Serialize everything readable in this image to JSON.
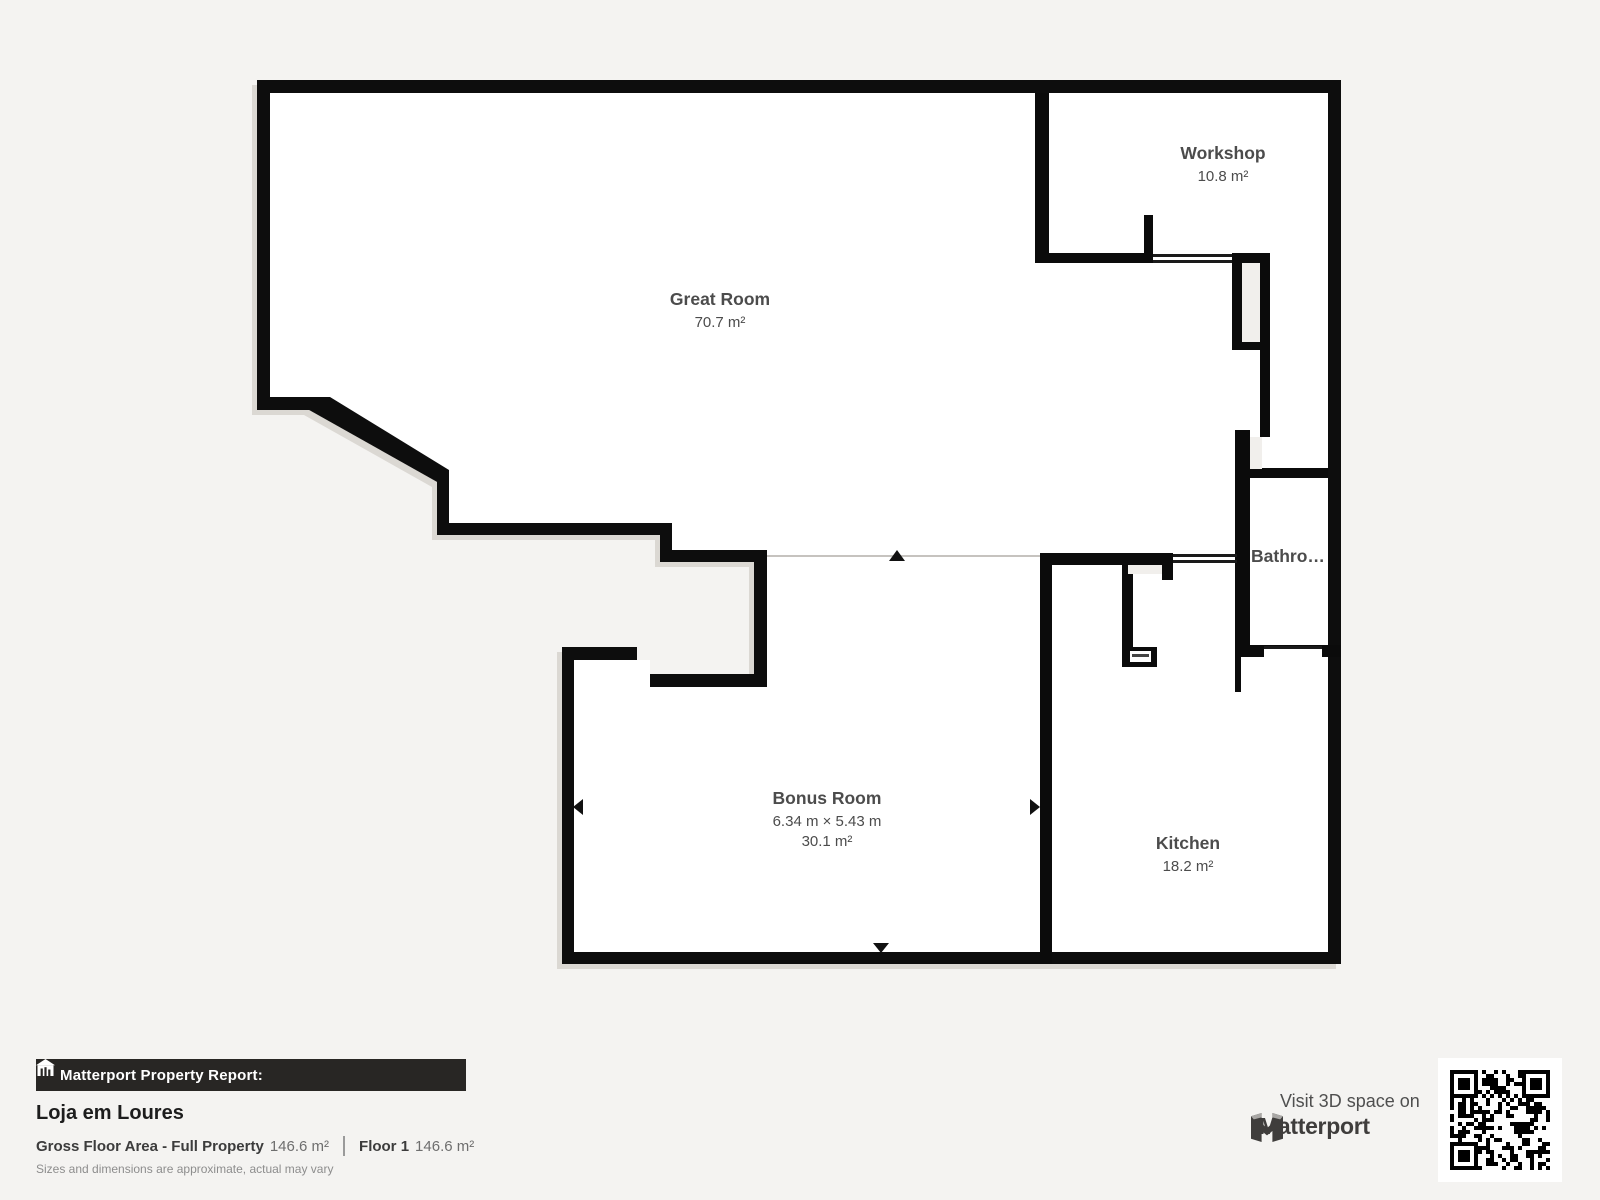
{
  "rooms": {
    "great_room": {
      "name": "Great Room",
      "area": "70.7 m²"
    },
    "workshop": {
      "name": "Workshop",
      "area": "10.8 m²"
    },
    "bathroom": {
      "name": "Bathro…"
    },
    "bonus_room": {
      "name": "Bonus Room",
      "dimensions": "6.34 m × 5.43 m",
      "area": "30.1 m²"
    },
    "kitchen": {
      "name": "Kitchen",
      "area": "18.2 m²"
    }
  },
  "report": {
    "banner_label": "Matterport Property Report:",
    "property_name": "Loja em Loures",
    "gfa_label": "Gross Floor Area - Full Property",
    "gfa_value": "146.6 m²",
    "floor_label": "Floor 1",
    "floor_value": "146.6 m²",
    "disclaimer": "Sizes and dimensions are approximate, actual may vary"
  },
  "cta": {
    "visit_label": "Visit 3D space on",
    "brand_name": "Matterport"
  },
  "icons": {
    "banner": "building-report-icon",
    "brand": "matterport-m-icon",
    "qr": "qr-code"
  },
  "colors": {
    "background": "#f4f3f1",
    "walls": "#0b0b0b",
    "floor": "#ffffff",
    "shaft": "#f1efec",
    "thin_line": "#c6c3bf",
    "label_text": "#4c4c4c",
    "banner_bg": "#282624",
    "banner_text": "#ffffff",
    "brand_text": "#3f3d3c"
  }
}
